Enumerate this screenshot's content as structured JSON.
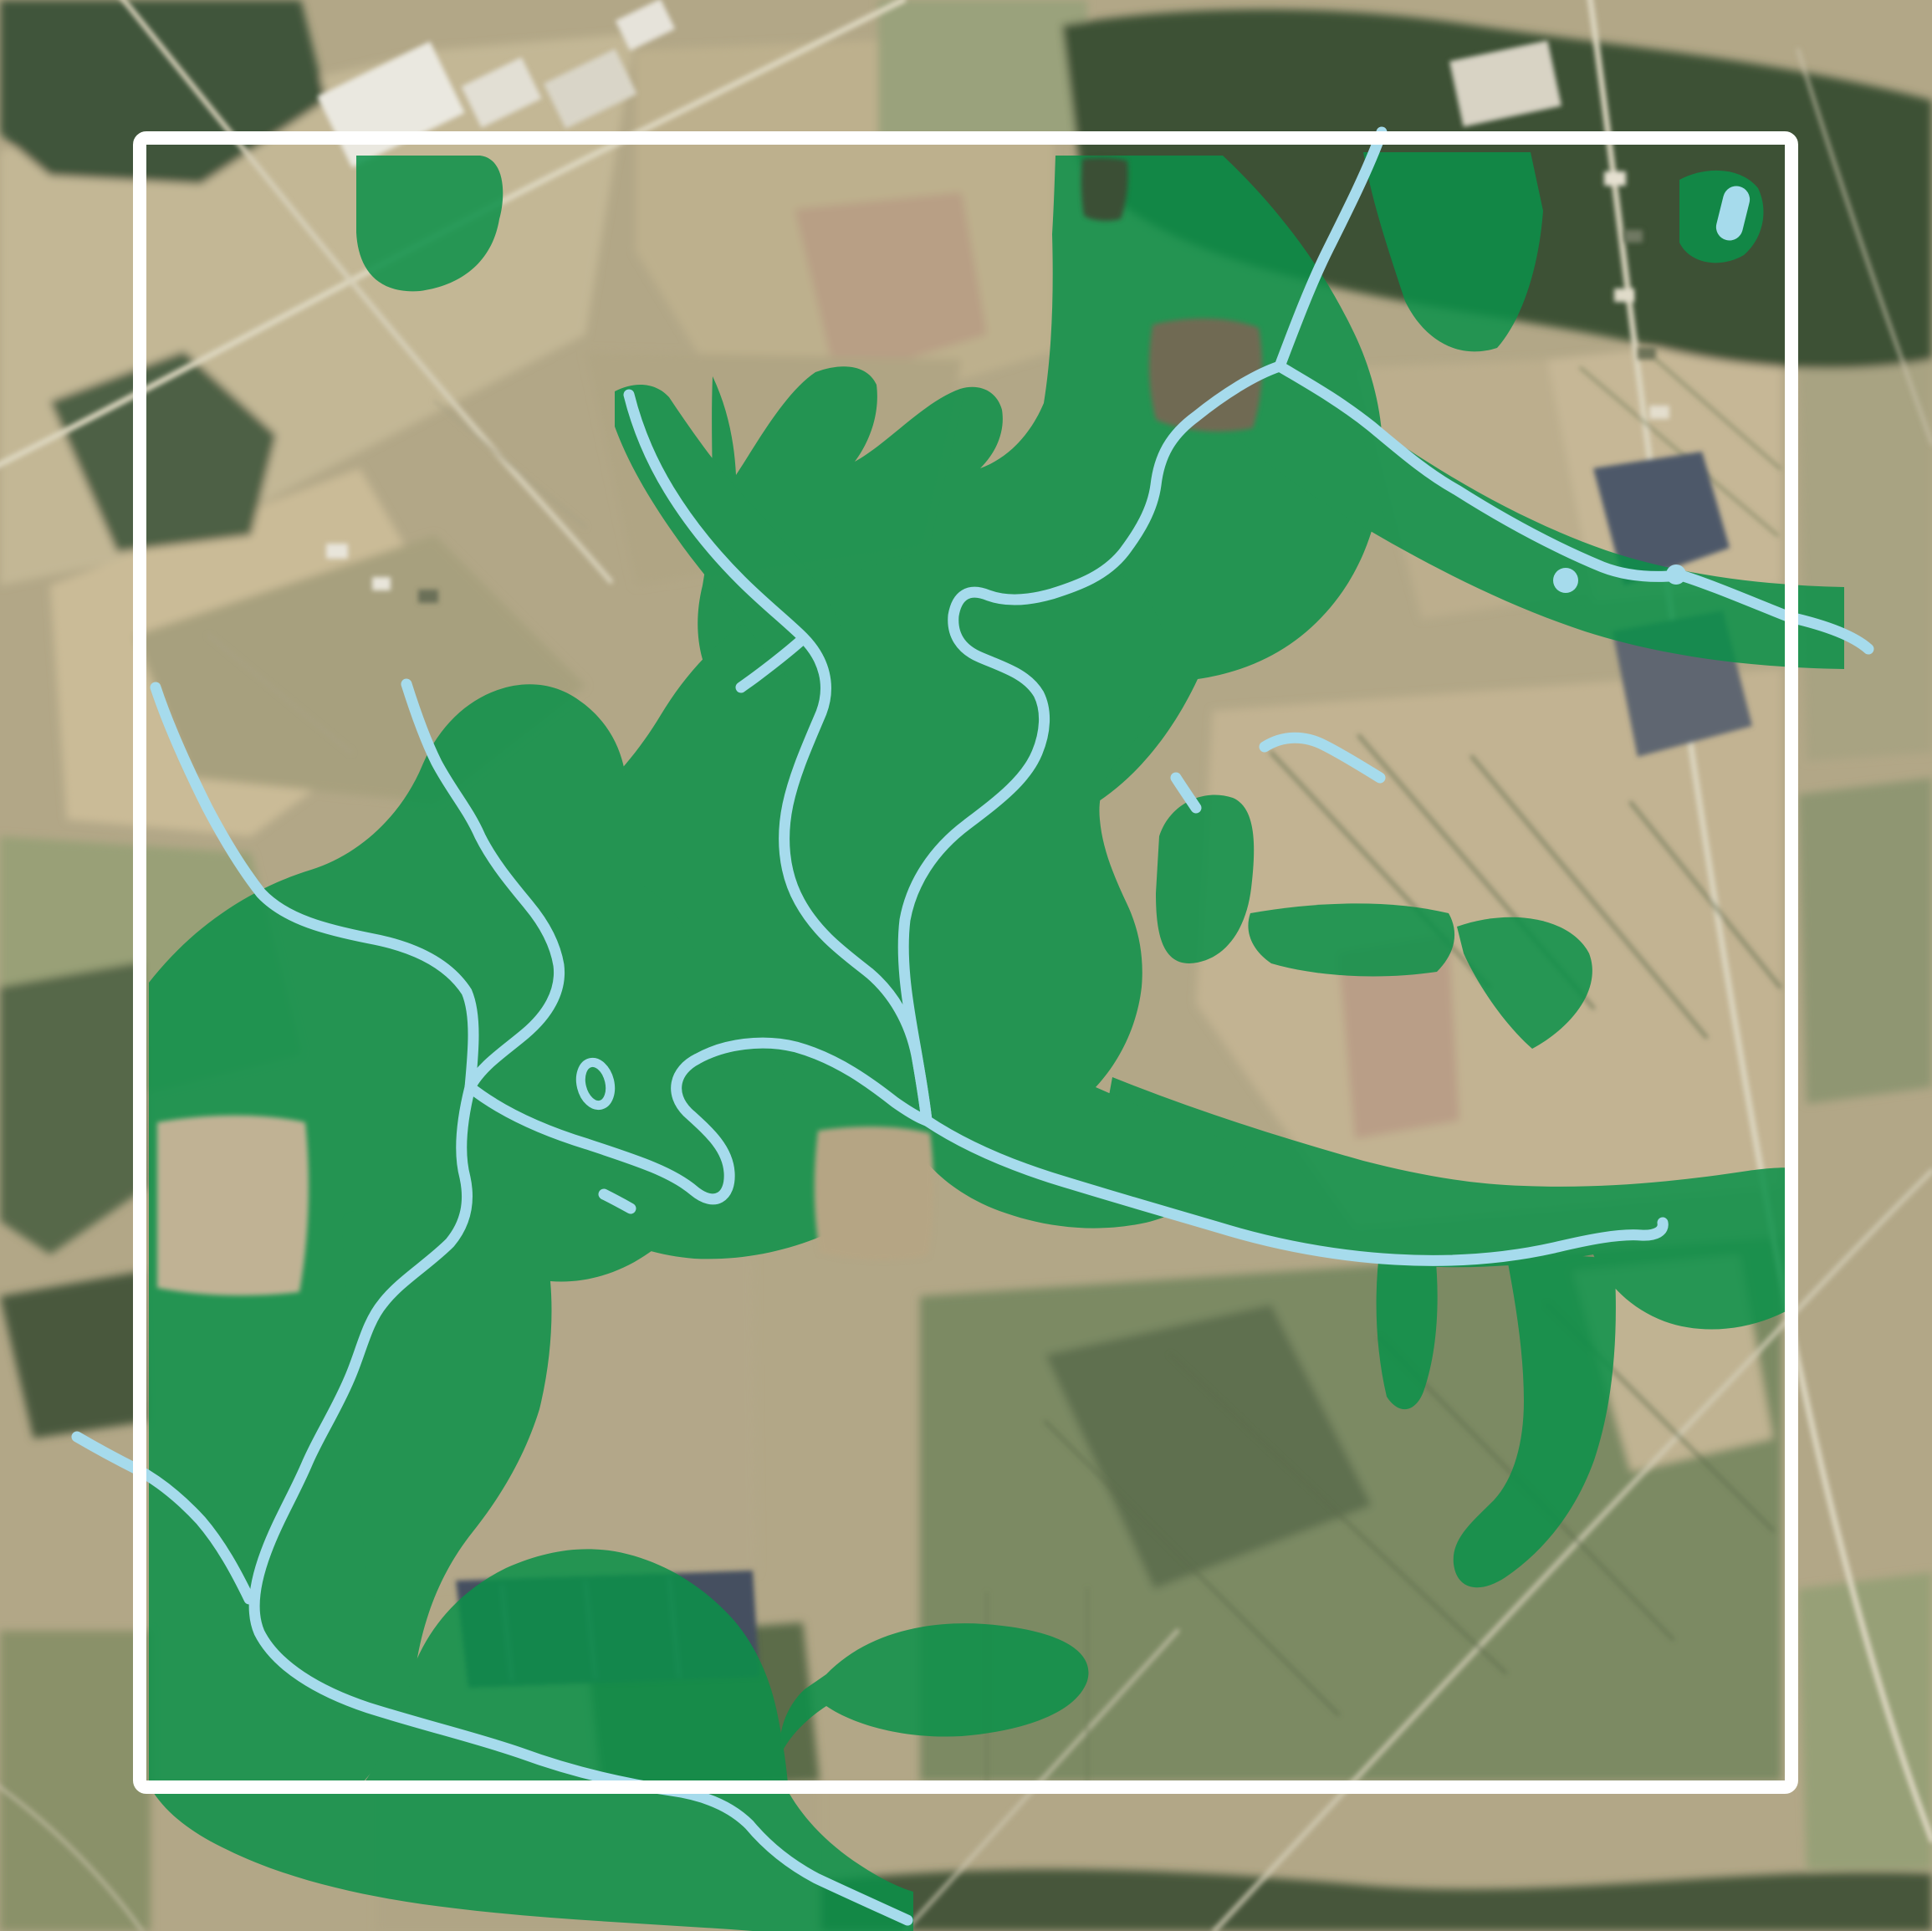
{
  "map": {
    "title": "satellite-map-with-greenlands-overlay",
    "description": "Aerial/satellite farmland scene with a semi-transparent green conservation overlay, light-blue stream network with ponds, enclosed by a white square survey frame",
    "colors": {
      "terrain_tan": "#b2a787",
      "forest_dark": "#3c5134",
      "overlay_green": "#0b9149",
      "stream_blue": "#a6dbec",
      "pond_blue": "#a6dbec",
      "frame_white": "#ffffff",
      "solar_navy": "#4d5969",
      "road_pale": "#dcd6c0"
    },
    "frame": {
      "shape": "square",
      "stroke_px": 16
    },
    "layers": [
      {
        "id": "satellite-base",
        "label": "satellite imagery",
        "interactable": false
      },
      {
        "id": "greenlands-overlay",
        "label": "green overlay polygons",
        "feature_count": 16
      },
      {
        "id": "watercourses",
        "label": "streams, ponds and ring pond",
        "feature_count": 17
      },
      {
        "id": "survey-frame",
        "label": "white map frame",
        "feature_count": 1
      }
    ]
  }
}
